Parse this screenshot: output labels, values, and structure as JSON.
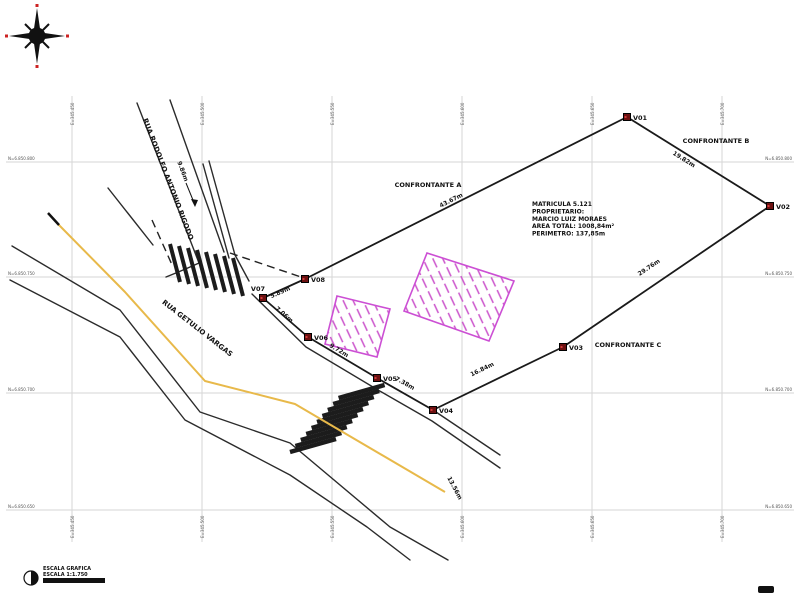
{
  "canvas": {
    "width": 800,
    "height": 600
  },
  "colors": {
    "boundary": "#1a1a1a",
    "grid_line": "#d6d6d6",
    "vertex_fill": "#6d1111",
    "building_outline": "#cc4fd4",
    "road_centerline": "#e8b94a",
    "street_line": "#2b2b2b",
    "compass_red": "#cc2222"
  },
  "compass": {
    "name": "north-compass-rose"
  },
  "grid": {
    "verticals": [
      {
        "x": 72,
        "label": "E=345.450"
      },
      {
        "x": 202,
        "label": "E=345.500"
      },
      {
        "x": 332,
        "label": "E=345.550"
      },
      {
        "x": 462,
        "label": "E=345.600"
      },
      {
        "x": 592,
        "label": "E=345.650"
      },
      {
        "x": 722,
        "label": "E=345.700"
      }
    ],
    "horizontals": [
      {
        "y": 162,
        "label": "N=6.850.800"
      },
      {
        "y": 277,
        "label": "N=6.850.750"
      },
      {
        "y": 393,
        "label": "N=6.850.700"
      },
      {
        "y": 510,
        "label": "N=6.850.650"
      }
    ]
  },
  "property": {
    "info": {
      "x": 532,
      "y": 206,
      "lines": [
        "MATRICULA 5.121",
        "PROPRIETARIO:",
        "MARCIO LUIZ MORAES",
        "AREA TOTAL: 1008,84m²",
        "PERIMETRO: 137,85m"
      ]
    },
    "vertices": [
      {
        "id": "V01",
        "x": 627,
        "y": 117,
        "ldx": 6,
        "ldy": 3
      },
      {
        "id": "V02",
        "x": 770,
        "y": 206,
        "ldx": 6,
        "ldy": 3
      },
      {
        "id": "V03",
        "x": 563,
        "y": 347,
        "ldx": 6,
        "ldy": 3
      },
      {
        "id": "V04",
        "x": 433,
        "y": 410,
        "ldx": 6,
        "ldy": 3
      },
      {
        "id": "V05",
        "x": 377,
        "y": 378,
        "ldx": 6,
        "ldy": 3
      },
      {
        "id": "V06",
        "x": 308,
        "y": 337,
        "ldx": 6,
        "ldy": 3
      },
      {
        "id": "V07",
        "x": 263,
        "y": 298,
        "ldx": 2,
        "ldy": -7,
        "anchor": "end"
      },
      {
        "id": "V08",
        "x": 305,
        "y": 279,
        "ldx": 6,
        "ldy": 3
      }
    ]
  },
  "labels": [
    {
      "name": "street-name-rodolfo",
      "text": "RUA RODOLFO ANTONIO RIGODO",
      "x": 166,
      "y": 180,
      "rot": 69,
      "size": 7
    },
    {
      "name": "street-name-getulio",
      "text": "RUA GETULIO VARGAS",
      "x": 196,
      "y": 330,
      "rot": 38,
      "size": 7
    },
    {
      "name": "confrontante-a",
      "text": "CONFRONTANTE A",
      "x": 428,
      "y": 187,
      "rot": 0,
      "size": 6.5
    },
    {
      "name": "confrontante-b",
      "text": "CONFRONTANTE B",
      "x": 716,
      "y": 143,
      "rot": 0,
      "size": 6.5
    },
    {
      "name": "confrontante-c",
      "text": "CONFRONTANTE C",
      "x": 628,
      "y": 347,
      "rot": 0,
      "size": 6.5
    },
    {
      "name": "dist-v08-v01",
      "text": "43.67m",
      "x": 452,
      "y": 202,
      "rot": -27,
      "size": 6
    },
    {
      "name": "dist-v01-v02",
      "text": "19.82m",
      "x": 683,
      "y": 161,
      "rot": 32,
      "size": 6
    },
    {
      "name": "dist-v02-v03",
      "text": "29.76m",
      "x": 650,
      "y": 269,
      "rot": -34,
      "size": 6
    },
    {
      "name": "dist-v03-v04",
      "text": "16.84m",
      "x": 483,
      "y": 371,
      "rot": -26,
      "size": 6
    },
    {
      "name": "dist-v04-v05",
      "text": "7.38m",
      "x": 404,
      "y": 385,
      "rot": 29,
      "size": 6
    },
    {
      "name": "dist-v05-v06",
      "text": "9.72m",
      "x": 338,
      "y": 352,
      "rot": 31,
      "size": 6
    },
    {
      "name": "dist-v06-v07",
      "text": "7.06m",
      "x": 283,
      "y": 316,
      "rot": 41,
      "size": 6
    },
    {
      "name": "dist-v07-v08",
      "text": "5.89m",
      "x": 281,
      "y": 294,
      "rot": -24,
      "size": 6
    },
    {
      "name": "width-rodolfo",
      "text": "9.86m",
      "x": 181,
      "y": 172,
      "rot": 69,
      "size": 6
    },
    {
      "name": "dist-curb",
      "text": "13.56m",
      "x": 453,
      "y": 489,
      "rot": 62,
      "size": 6
    }
  ],
  "legend": {
    "line1": "ESCALA GRAFICA",
    "line2": "ESCALA 1:1.750"
  }
}
